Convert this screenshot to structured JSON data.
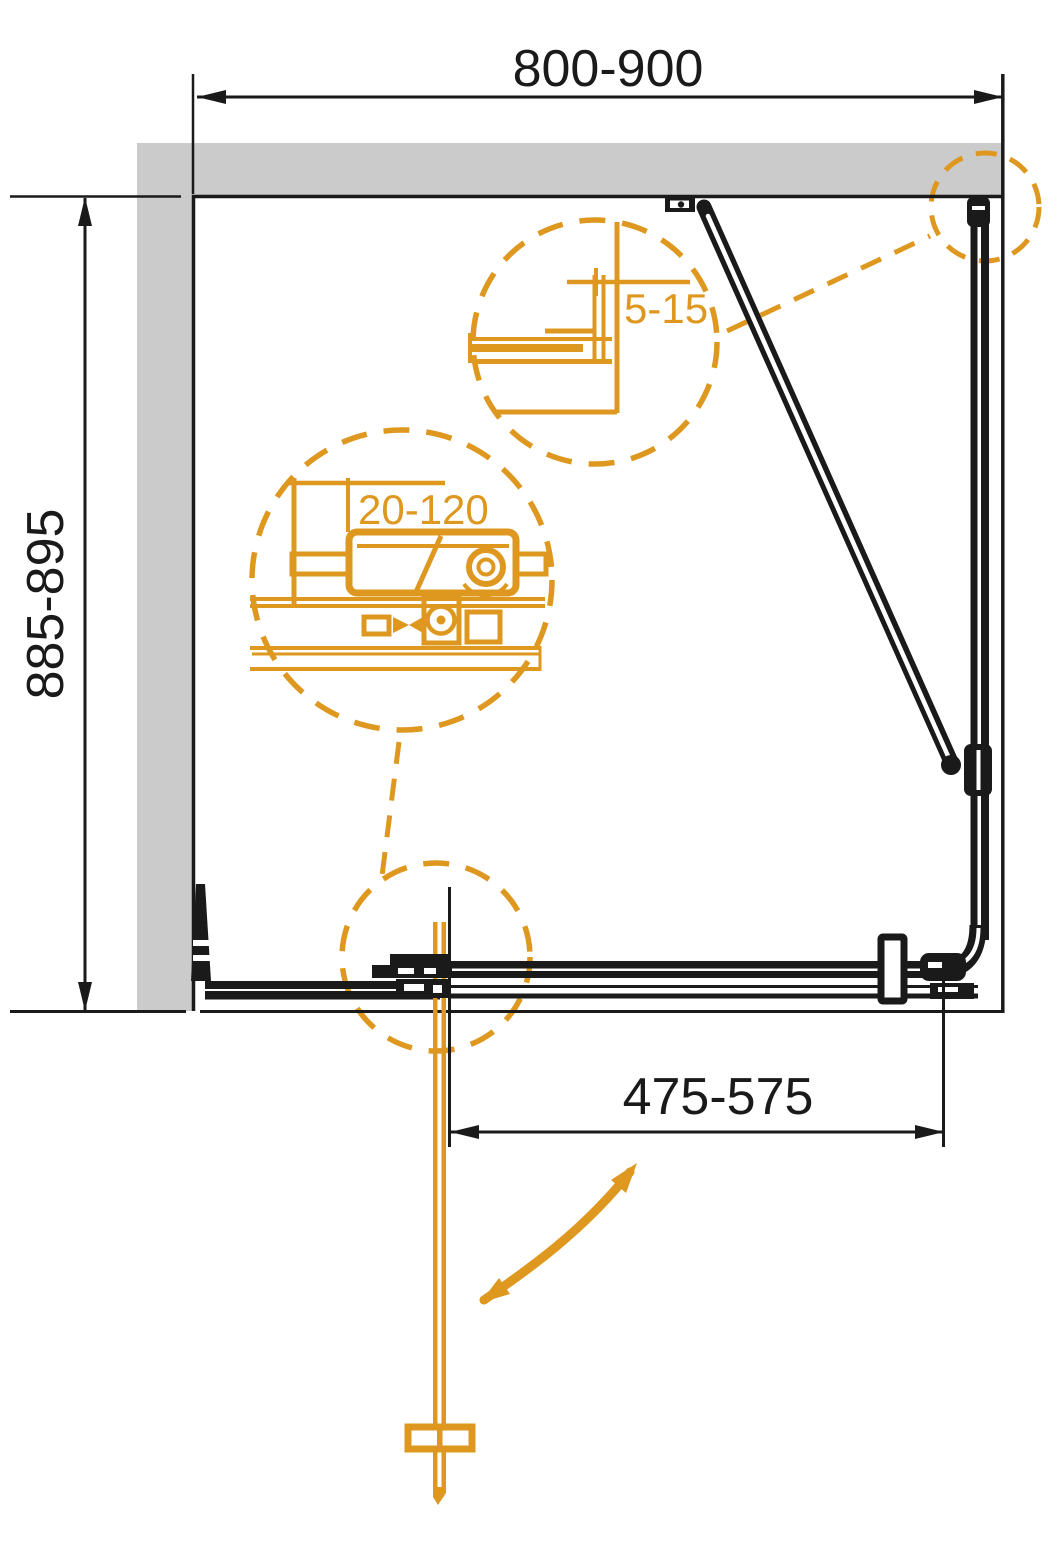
{
  "diagram": {
    "type": "shower-enclosure-installation-plan",
    "colors": {
      "accent_orange": "#DE9820",
      "wall_gray": "#CBCBCB",
      "line_black": "#1A1A1A"
    },
    "labels": {
      "width": "800-900",
      "depth": "885-895",
      "door_width": "475-575",
      "wall_gap": "5-15",
      "adjustment_range": "20-120"
    }
  }
}
